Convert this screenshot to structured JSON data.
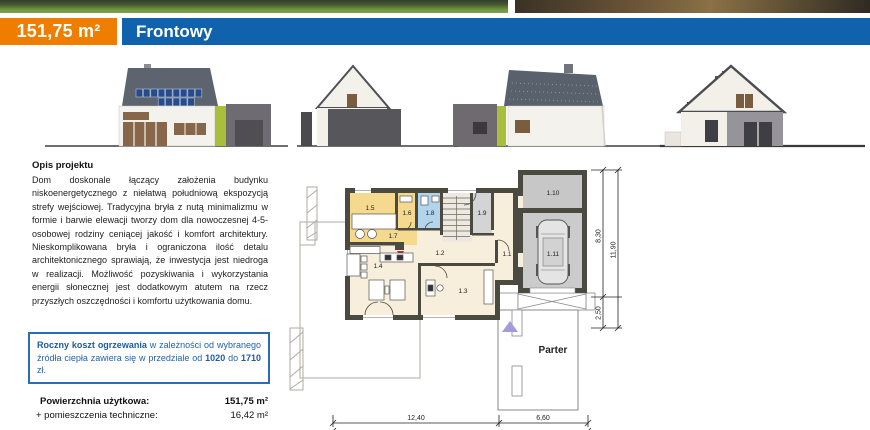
{
  "header": {
    "area_badge": "151,75 m²",
    "title": "Frontowy"
  },
  "colors": {
    "accent_orange": "#ee7d00",
    "accent_blue": "#1162ad",
    "plan_wall": "#4b4a40",
    "plan_room_yellow": "#f4d98e",
    "plan_room_blue": "#b3d4ed",
    "plan_room_cream": "#f7efdb",
    "plan_room_gray": "#cbcbcb"
  },
  "description": {
    "heading": "Opis projektu",
    "body": "Dom doskonale łączący założenia budynku niskoenergetycznego z niełatwą południową ekspozycją strefy wejściowej. Tradycyjna bryła z nutą minimalizmu w formie i barwie elewacji tworzy dom dla nowoczesnej 4-5-osobowej rodziny ceniącej jakość i komfort architektury. Nieskomplikowana bryła i ograniczona ilość detalu architektonicznego sprawiają, że inwestycja jest niedroga w realizacji. Możliwość pozyskiwania i wykorzystania energii słonecznej jest dodatkowym atutem na rzecz przyszłych oszczędności i komfortu użytkowania domu."
  },
  "heating_note": {
    "bold_lead": "Roczny koszt ogrzewania",
    "text_mid": " w zależności od wybranego źródła ciepła zawiera się w przedziale od ",
    "value_from": "1020",
    "text_to": " do ",
    "value_to": "1710",
    "text_end": " zł."
  },
  "areas": {
    "rows": [
      {
        "label": "Powierzchnia użytkowa:",
        "value": "151,75 m²"
      },
      {
        "label": "+ pomieszczenia techniczne:",
        "value": "16,42 m²"
      }
    ]
  },
  "plan": {
    "floor_label": "Parter",
    "rooms": {
      "r11": "1.1",
      "r12": "1.2",
      "r13": "1.3",
      "r14": "1.4",
      "r15": "1.5",
      "r16": "1.6",
      "r17": "1.7",
      "r18": "1.8",
      "r19": "1.9",
      "r110": "1.10",
      "r111": "1.11"
    },
    "dimensions": {
      "bottom_left": "12,40",
      "bottom_right": "6,60",
      "bottom_total": "19,00",
      "right_upper": "8,30",
      "right_lower": "2,50",
      "right_total": "11,90"
    }
  }
}
